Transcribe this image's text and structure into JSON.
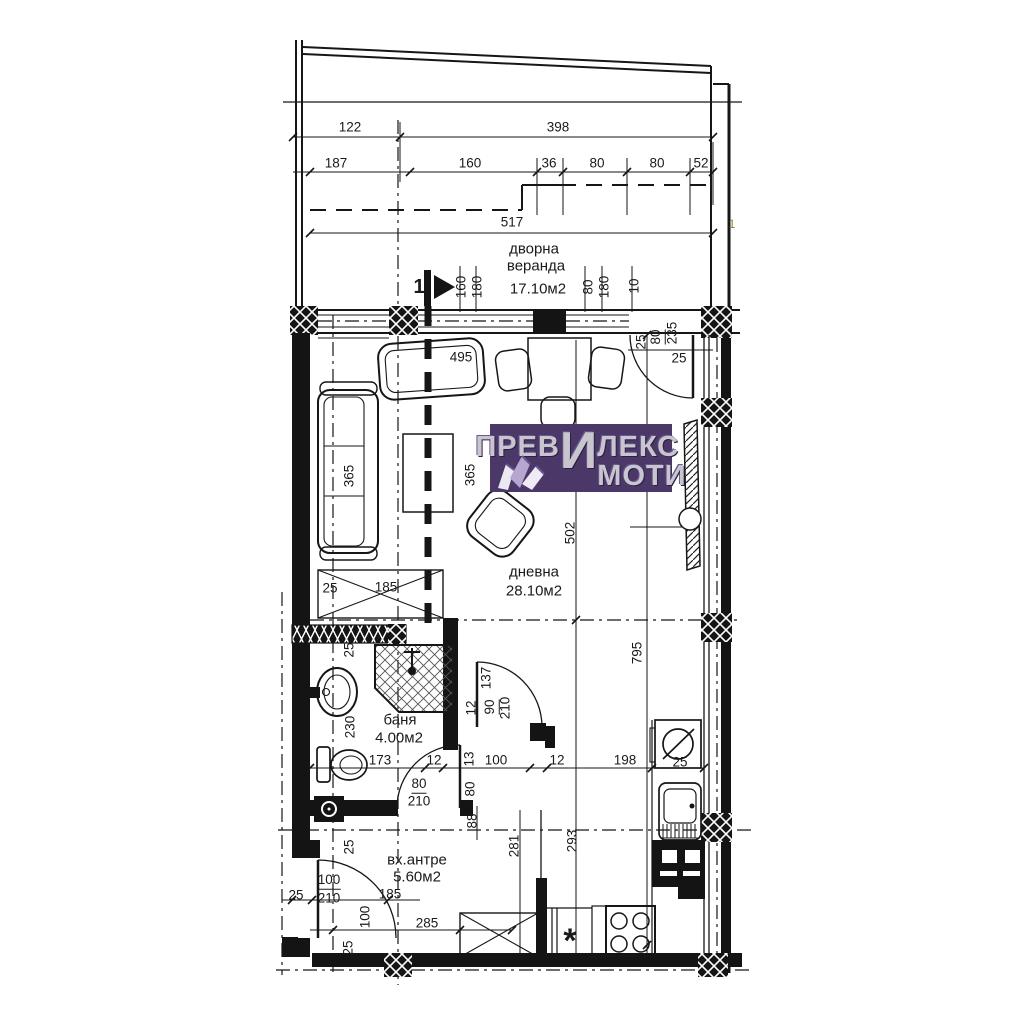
{
  "page": {
    "background": "#ffffff",
    "ink": "#1a1a1a"
  },
  "logo": {
    "part1": "ПРЕВ",
    "big_letter": "И",
    "part2": "ЛЕКС",
    "part3": "МОТИ",
    "full_name": "ПРЕВИЛЕКС ИМОТИ",
    "bg": "#4b3869",
    "fg": "#c9c5cf"
  },
  "rooms": [
    {
      "name": "дворна веранда",
      "area": "17.10м2"
    },
    {
      "name": "дневна",
      "area": "28.10м2"
    },
    {
      "name": "баня",
      "area": "4.00м2"
    },
    {
      "name": "вх.антре",
      "area": "5.60м2"
    }
  ],
  "section_marker": {
    "label": "1"
  },
  "labels": [
    {
      "t": "122",
      "x": 350,
      "y": 127
    },
    {
      "t": "398",
      "x": 558,
      "y": 127
    },
    {
      "t": "187",
      "x": 336,
      "y": 163
    },
    {
      "t": "160",
      "x": 470,
      "y": 163
    },
    {
      "t": "36",
      "x": 549,
      "y": 163
    },
    {
      "t": "80",
      "x": 597,
      "y": 163
    },
    {
      "t": "80",
      "x": 657,
      "y": 163
    },
    {
      "t": "52",
      "x": 701,
      "y": 163
    },
    {
      "t": "517",
      "x": 512,
      "y": 222
    },
    {
      "t": "1",
      "x": 732,
      "y": 224,
      "s": 12,
      "c": "#8f7f2f"
    },
    {
      "t": "дворна",
      "x": 534,
      "y": 249,
      "s": 15,
      "n": "room-label"
    },
    {
      "t": "веранда",
      "x": 536,
      "y": 266,
      "s": 15,
      "n": "room-label"
    },
    {
      "t": "17.10м2",
      "x": 538,
      "y": 289,
      "s": 15,
      "n": "room-area"
    },
    {
      "t": "1",
      "x": 419,
      "y": 287,
      "s": 20,
      "b": true,
      "n": "section-marker-label"
    },
    {
      "t": "160",
      "x": 461,
      "y": 287,
      "r": -90
    },
    {
      "t": "180",
      "x": 477,
      "y": 287,
      "r": -90
    },
    {
      "t": "80",
      "x": 588,
      "y": 287,
      "r": -90
    },
    {
      "t": "180",
      "x": 604,
      "y": 287,
      "r": -90
    },
    {
      "t": "10",
      "x": 634,
      "y": 286,
      "r": -90
    },
    {
      "t": "25",
      "x": 641,
      "y": 342,
      "r": -90
    },
    {
      "t": "80",
      "x": 657,
      "y": 337,
      "r": -90,
      "u": true
    },
    {
      "t": "235",
      "x": 672,
      "y": 333,
      "r": -90
    },
    {
      "t": "25",
      "x": 679,
      "y": 358
    },
    {
      "t": "495",
      "x": 461,
      "y": 357
    },
    {
      "t": "365",
      "x": 349,
      "y": 476,
      "r": -90
    },
    {
      "t": "365",
      "x": 470,
      "y": 475,
      "r": -90
    },
    {
      "t": "дневна",
      "x": 534,
      "y": 572,
      "s": 15,
      "n": "room-label"
    },
    {
      "t": "28.10м2",
      "x": 534,
      "y": 591,
      "s": 15,
      "n": "room-area"
    },
    {
      "t": "502",
      "x": 570,
      "y": 533,
      "r": -90
    },
    {
      "t": "795",
      "x": 637,
      "y": 653,
      "r": -90
    },
    {
      "t": "25",
      "x": 330,
      "y": 588
    },
    {
      "t": "185",
      "x": 386,
      "y": 587
    },
    {
      "t": "25",
      "x": 349,
      "y": 650,
      "r": -90
    },
    {
      "t": "230",
      "x": 350,
      "y": 727,
      "r": -90
    },
    {
      "t": "баня",
      "x": 400,
      "y": 720,
      "s": 15,
      "n": "room-label"
    },
    {
      "t": "4.00м2",
      "x": 399,
      "y": 738,
      "s": 15,
      "n": "room-area"
    },
    {
      "t": "173",
      "x": 380,
      "y": 760
    },
    {
      "t": "12",
      "x": 434,
      "y": 760
    },
    {
      "t": "137",
      "x": 486,
      "y": 678,
      "r": -90
    },
    {
      "t": "12",
      "x": 471,
      "y": 708,
      "r": -90
    },
    {
      "t": "90",
      "x": 491,
      "y": 707,
      "r": -90,
      "u": true
    },
    {
      "t": "210",
      "x": 505,
      "y": 708,
      "r": -90
    },
    {
      "t": "13",
      "x": 469,
      "y": 759,
      "r": -90
    },
    {
      "t": "100",
      "x": 496,
      "y": 760
    },
    {
      "t": "80",
      "x": 470,
      "y": 789,
      "r": -90
    },
    {
      "t": "80",
      "x": 419,
      "y": 785,
      "u": true
    },
    {
      "t": "210",
      "x": 419,
      "y": 801
    },
    {
      "t": "12",
      "x": 557,
      "y": 760
    },
    {
      "t": "198",
      "x": 625,
      "y": 760
    },
    {
      "t": "25",
      "x": 680,
      "y": 762
    },
    {
      "t": "25",
      "x": 349,
      "y": 847,
      "r": -90
    },
    {
      "t": "вх.антре",
      "x": 417,
      "y": 860,
      "s": 15,
      "n": "room-label"
    },
    {
      "t": "5.60м2",
      "x": 417,
      "y": 877,
      "s": 15,
      "n": "room-area"
    },
    {
      "t": "88",
      "x": 472,
      "y": 821,
      "r": -90
    },
    {
      "t": "281",
      "x": 514,
      "y": 846,
      "r": -90
    },
    {
      "t": "293",
      "x": 572,
      "y": 841,
      "r": -90
    },
    {
      "t": "100",
      "x": 329,
      "y": 881,
      "u": true
    },
    {
      "t": "210",
      "x": 329,
      "y": 898
    },
    {
      "t": "25",
      "x": 296,
      "y": 895
    },
    {
      "t": "185",
      "x": 390,
      "y": 894
    },
    {
      "t": "100",
      "x": 365,
      "y": 917,
      "r": -90
    },
    {
      "t": "25",
      "x": 348,
      "y": 948,
      "r": -90
    },
    {
      "t": "285",
      "x": 427,
      "y": 923
    },
    {
      "t": "*",
      "x": 570,
      "y": 941,
      "s": 34,
      "b": true,
      "n": "gas-point-symbol"
    }
  ]
}
